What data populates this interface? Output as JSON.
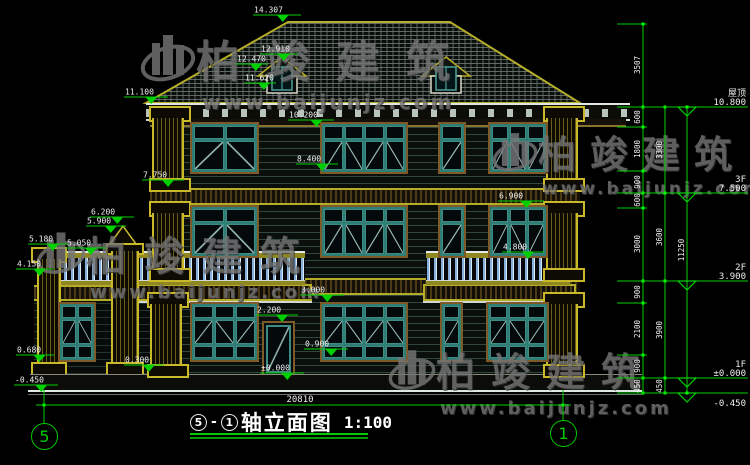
{
  "drawing": {
    "title": {
      "axis_from": "5",
      "separator": "-",
      "axis_to": "1",
      "name": "轴立面图",
      "scale": "1:100"
    },
    "axes": {
      "left": "5",
      "right": "1"
    },
    "watermark": {
      "brand": "柏竣建筑",
      "url": "www.baijunjz.com"
    },
    "bottom_dim": {
      "label": "20810",
      "x1": 44,
      "x2": 563,
      "y": 405,
      "label_x": 300
    },
    "witness_lines": [
      {
        "x": 44,
        "y1": 390,
        "y2": 423
      },
      {
        "x": 563,
        "y1": 390,
        "y2": 420
      }
    ],
    "floor_levels": [
      {
        "name": "屋顶",
        "value": "10.800",
        "y": 107,
        "label_below": false
      },
      {
        "name": "3F",
        "value": "7.500",
        "y": 193,
        "label_below": false
      },
      {
        "name": "2F",
        "value": "3.900",
        "y": 281,
        "label_below": false
      },
      {
        "name": "1F",
        "value": "±0.000",
        "y": 378,
        "label_below": false
      },
      {
        "name": "",
        "value": "-0.450",
        "y": 393,
        "label_below": true
      }
    ],
    "spot_elevations": [
      {
        "label": "14.307",
        "x": 253,
        "y": 22,
        "w": 48
      },
      {
        "label": "12.910",
        "x": 260,
        "y": 61,
        "w": 38
      },
      {
        "label": "12.470",
        "x": 236,
        "y": 71,
        "w": 32
      },
      {
        "label": "11.620",
        "x": 244,
        "y": 90,
        "w": 32
      },
      {
        "label": "11.100",
        "x": 124,
        "y": 104,
        "w": 44
      },
      {
        "label": "10.200",
        "x": 288,
        "y": 127,
        "w": 46
      },
      {
        "label": "8.400",
        "x": 296,
        "y": 171,
        "w": 42
      },
      {
        "label": "7.750",
        "x": 142,
        "y": 187,
        "w": 42
      },
      {
        "label": "6.900",
        "x": 498,
        "y": 208,
        "w": 46
      },
      {
        "label": "6.200",
        "x": 90,
        "y": 224,
        "w": 44
      },
      {
        "label": "5.900",
        "x": 86,
        "y": 233,
        "w": 40
      },
      {
        "label": "5.180",
        "x": 28,
        "y": 251,
        "w": 40
      },
      {
        "label": "5.050",
        "x": 66,
        "y": 255,
        "w": 40
      },
      {
        "label": "4.800",
        "x": 502,
        "y": 259,
        "w": 42
      },
      {
        "label": "4.150",
        "x": 16,
        "y": 276,
        "w": 38
      },
      {
        "label": "3.000",
        "x": 300,
        "y": 302,
        "w": 44
      },
      {
        "label": "2.200",
        "x": 256,
        "y": 322,
        "w": 42
      },
      {
        "label": "0.900",
        "x": 304,
        "y": 356,
        "w": 44
      },
      {
        "label": "0.680",
        "x": 16,
        "y": 362,
        "w": 38
      },
      {
        "label": "0.300",
        "x": 124,
        "y": 372,
        "w": 40
      },
      {
        "label": "±0.000",
        "x": 260,
        "y": 380,
        "w": 44
      },
      {
        "label": "-0.450",
        "x": 14,
        "y": 392,
        "w": 44
      }
    ],
    "dim_columns": [
      {
        "x": 643,
        "ticks": [
          24,
          107,
          127,
          171,
          193,
          208,
          281,
          303,
          355,
          378,
          393
        ],
        "labels": [
          {
            "text": "3507",
            "y": 65
          },
          {
            "text": "600",
            "y": 117
          },
          {
            "text": "1800",
            "y": 149
          },
          {
            "text": "900",
            "y": 182
          },
          {
            "text": "600",
            "y": 200
          },
          {
            "text": "3000",
            "y": 244
          },
          {
            "text": "900",
            "y": 292
          },
          {
            "text": "2100",
            "y": 329
          },
          {
            "text": "900",
            "y": 366
          },
          {
            "text": "450",
            "y": 386
          }
        ]
      },
      {
        "x": 665,
        "ticks": [
          107,
          193,
          281,
          378,
          393
        ],
        "labels": [
          {
            "text": "3300",
            "y": 150
          },
          {
            "text": "3600",
            "y": 237
          },
          {
            "text": "3900",
            "y": 330
          },
          {
            "text": "450",
            "y": 386
          }
        ]
      },
      {
        "x": 687,
        "ticks": [
          107,
          393
        ],
        "labels": [
          {
            "text": "11250",
            "y": 250
          }
        ]
      }
    ],
    "colors": {
      "dim_green": "#00d000",
      "tick_green": "#00ff00",
      "text_white": "#eeeeee",
      "accent_yellow": "#b5ac28",
      "frame_teal": "#4ba096",
      "trim_brown": "#7d5a28",
      "baluster_blue": "#86b0dc",
      "watermark_gray": "#757575"
    }
  }
}
